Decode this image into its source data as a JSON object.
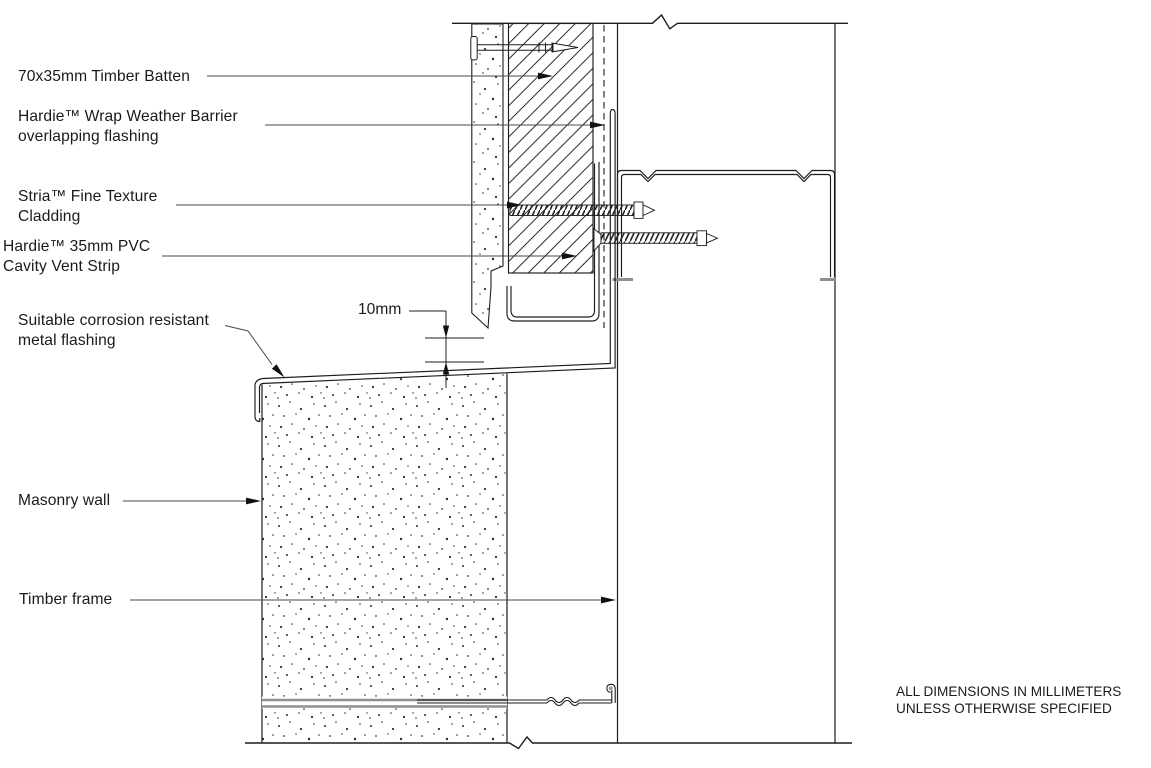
{
  "drawing": {
    "callouts": {
      "timber_batten": "70x35mm Timber Batten",
      "weather_barrier": "Hardie™ Wrap Weather Barrier\noverlapping flashing",
      "cladding": "Stria™ Fine Texture\nCladding",
      "cavity_vent_strip": "Hardie™ 35mm PVC\nCavity Vent Strip",
      "metal_flashing": "Suitable corrosion resistant\nmetal flashing",
      "masonry_wall": "Masonry wall",
      "timber_frame": "Timber frame"
    },
    "dimensions": {
      "cavity_gap": "10mm"
    },
    "notes": "ALL DIMENSIONS IN MILLIMETERS\nUNLESS OTHERWISE SPECIFIED",
    "colors": {
      "line": "#1c1c1c",
      "leader": "#4a4a4a",
      "muted_gray": "#8f8f8f",
      "background": "#ffffff"
    }
  }
}
